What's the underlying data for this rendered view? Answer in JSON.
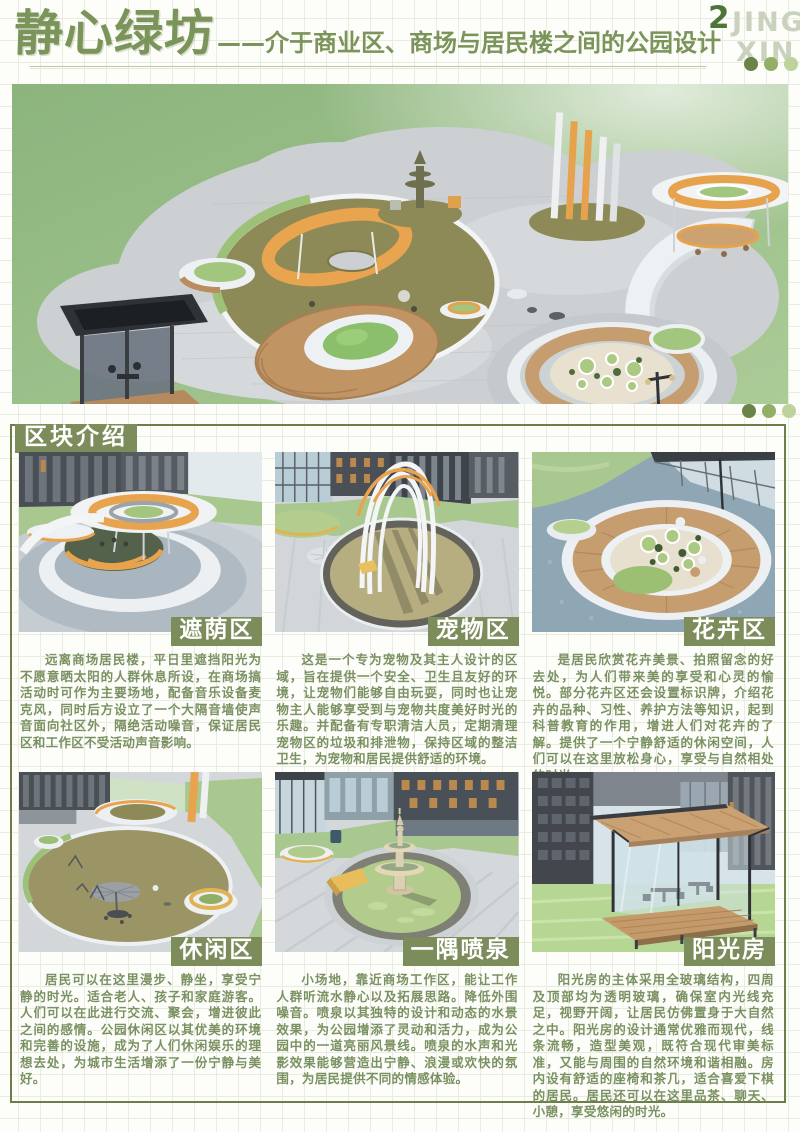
{
  "header": {
    "title": "静心绿坊",
    "subtitle": "——介于商业区、商场与居民楼之间的公园设计",
    "page_number": "2",
    "logo_line1": "JING",
    "logo_line2": "XIN"
  },
  "section": {
    "label": "区块介绍"
  },
  "zones": [
    {
      "name": "遮荫区",
      "description": "远离商场居民楼，平日里遮挡阳光为不愿意晒太阳的人群休息所设，在商场搞活动时可作为主要场地，配备音乐设备麦克风，同时后方设立了一个大隔音墙使声音面向社区外，隔绝活动噪音，保证居民区和工作区不受活动声音影响。"
    },
    {
      "name": "宠物区",
      "description": "这是一个专为宠物及其主人设计的区域，旨在提供一个安全、卫生且友好的环境，让宠物们能够自由玩耍，同时也让宠物主人能够享受到与宠物共度美好时光的乐趣。并配备有专职清洁人员，定期清理宠物区的垃圾和排泄物，保持区域的整洁卫生，为宠物和居民提供舒适的环境。"
    },
    {
      "name": "花卉区",
      "description": "是居民欣赏花卉美景、拍照留念的好去处，为人们带来美的享受和心灵的愉悦。部分花卉区还会设置标识牌，介绍花卉的品种、习性、养护方法等知识，起到科普教育的作用，增进人们对花卉的了解。提供了一个宁静舒适的休闲空间，人们可以在这里放松身心，享受与自然相处的时光。"
    },
    {
      "name": "休闲区",
      "description": "居民可以在这里漫步、静坐，享受宁静的时光。适合老人、孩子和家庭游客。人们可以在此进行交流、聚会，增进彼此之间的感情。公园休闲区以其优美的环境和完善的设施，成为了人们休闲娱乐的理想去处，为城市生活增添了一份宁静与美好。"
    },
    {
      "name": "一隅喷泉",
      "description": "小场地，靠近商场工作区，能让工作人群听流水静心以及拓展思路。降低外围噪音。喷泉以其独特的设计和动态的水景效果，为公园增添了灵动和活力，成为公园中的一道亮丽风景线。喷泉的水声和光影效果能够营造出宁静、浪漫或欢快的氛围，为居民提供不同的情感体验。"
    },
    {
      "name": "阳光房",
      "description": "阳光房的主体采用全玻璃结构，四周及顶部均为透明玻璃，确保室内光线充足，视野开阔，让居民仿佛置身于大自然之中。阳光房的设计通常优雅而现代，线条流畅，造型美观，既符合现代审美标准，又能与周围的自然环境和谐相融。房内设有舒适的座椅和茶几，适合喜爱下棋的居民。居民还可以在这里品茶、聊天、小憩，享受悠闲的时光。"
    }
  ],
  "palette": {
    "title_green": "#7a9459",
    "text_green": "#7a9161",
    "badge_background": "#7c8c5b",
    "box_border": "#6d7e4b",
    "page_number_green": "#4f7438",
    "logo_gray_green": "#c9d2bc",
    "dot_colors": [
      "#6a8347",
      "#93ae66",
      "#bed29b"
    ],
    "accent_orange": "#e8a34e"
  }
}
